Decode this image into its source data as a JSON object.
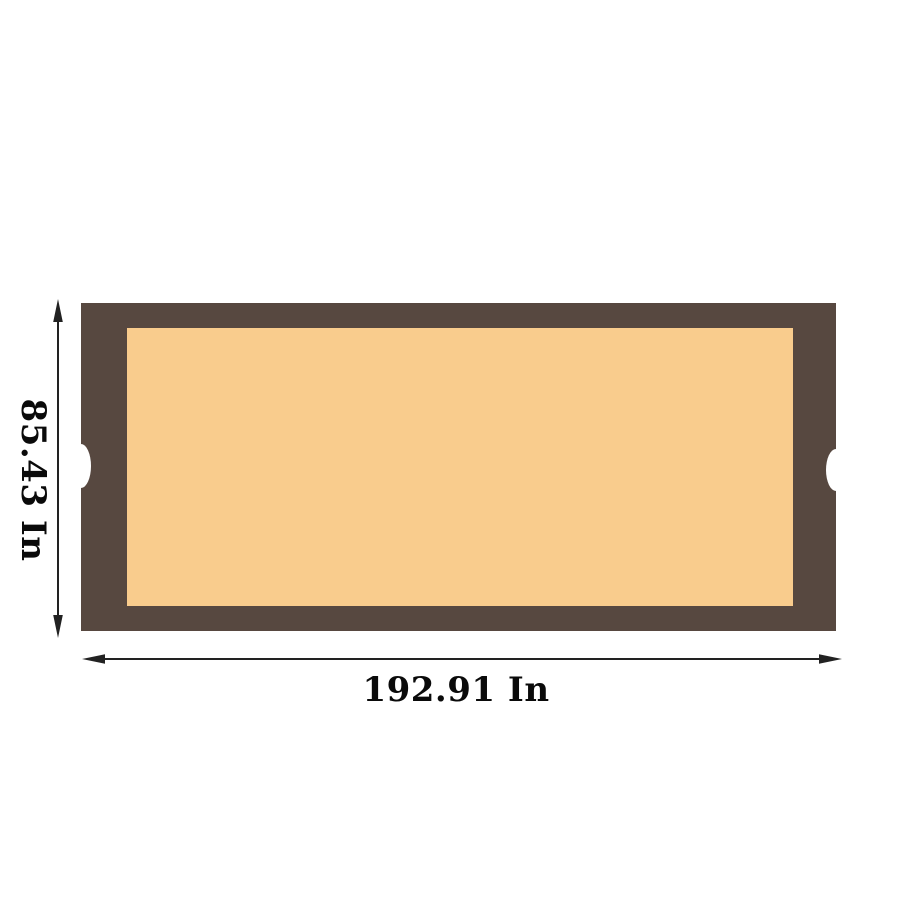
{
  "diagram": {
    "title": "product-dimension-diagram",
    "height_label": "85.43 In",
    "width_label": "192.91 In"
  },
  "colors": {
    "background": "#FFFFFF",
    "frame": "#574840",
    "surface": "#F9CC8D",
    "notch": "#FFFFFF",
    "dimension": "#222222",
    "label_text": "#0A0A0A"
  }
}
